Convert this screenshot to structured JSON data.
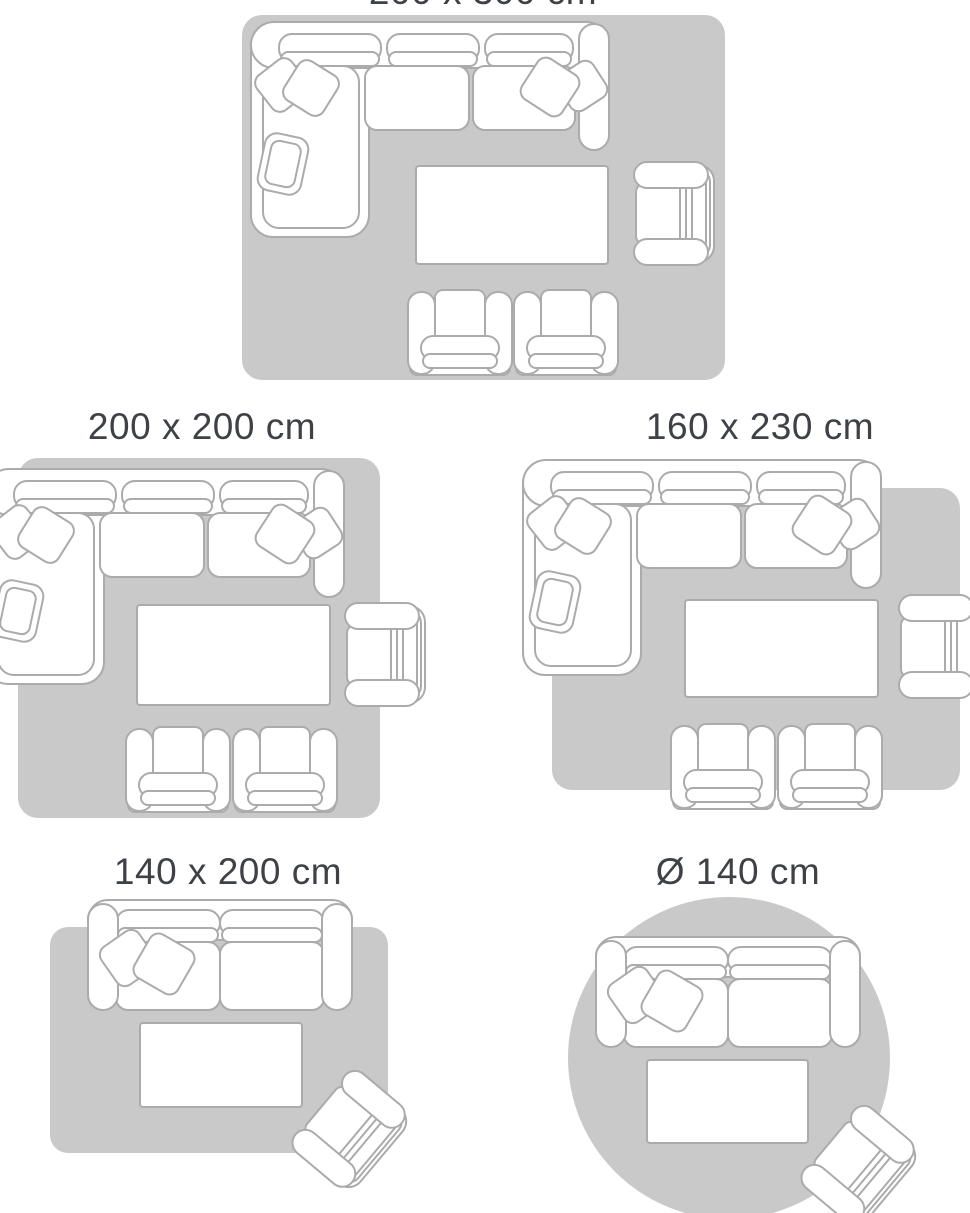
{
  "guide": {
    "description": "Rug size guide — top-view living room furniture layouts on rugs",
    "colors": {
      "background": "#ffffff",
      "rug_fill": "#c9c9c9",
      "furniture_fill": "#ffffff",
      "furniture_outline": "#ababab",
      "title_text": "#3e4146"
    },
    "sections": [
      {
        "id": "size-200x300",
        "title": "200 x 300 cm",
        "rug_shape": "rectangle",
        "note": "title partially cut off at top edge of image",
        "furniture": [
          "corner-sofa",
          "coffee-table",
          "armchair",
          "club-chair",
          "club-chair"
        ]
      },
      {
        "id": "size-200x200",
        "title": "200 x 200 cm",
        "rug_shape": "square",
        "furniture": [
          "corner-sofa",
          "coffee-table",
          "armchair",
          "club-chair",
          "club-chair"
        ]
      },
      {
        "id": "size-160x230",
        "title": "160 x 230 cm",
        "rug_shape": "rectangle",
        "furniture": [
          "corner-sofa",
          "coffee-table",
          "armchair",
          "club-chair",
          "club-chair"
        ]
      },
      {
        "id": "size-140x200",
        "title": "140 x 200 cm",
        "rug_shape": "rectangle",
        "furniture": [
          "two-seater-sofa",
          "coffee-table",
          "armchair"
        ]
      },
      {
        "id": "size-d140",
        "title": "Ø 140 cm",
        "rug_shape": "circle",
        "furniture": [
          "two-seater-sofa",
          "coffee-table",
          "armchair"
        ]
      }
    ]
  }
}
